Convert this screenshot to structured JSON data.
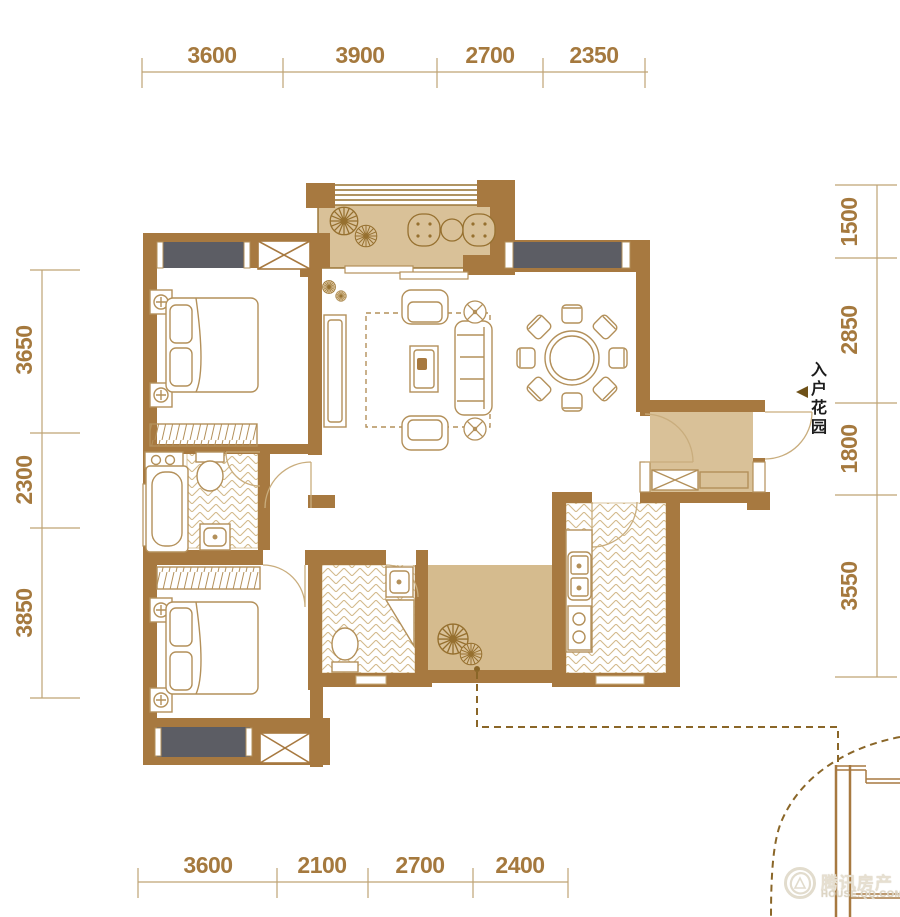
{
  "plan": {
    "dimensions": {
      "top": [
        "3600",
        "3900",
        "2700",
        "2350"
      ],
      "bottom": [
        "3600",
        "2100",
        "2700",
        "2400"
      ],
      "left": [
        "3650",
        "2300",
        "3850"
      ],
      "right": [
        "1500",
        "2850",
        "1800",
        "3550"
      ]
    },
    "labels": {
      "entry_garden": "入户花园"
    },
    "watermark": {
      "brand": "腾讯房产",
      "site": "HOUSE.QQ.COM"
    },
    "colors": {
      "wall": "#a77940",
      "tan_fill": "#d9c198",
      "window_gray": "#5c5d64",
      "dimension_text": "#a5793e",
      "furniture_stroke": "#b3905a",
      "dashed_line": "#8a6628"
    },
    "icons": {
      "entry_arrow": "left-triangle",
      "plants": "spiky-plant-icon",
      "shafts": "x-box-shaft-icon",
      "watermark_logo": "circle-logo-icon"
    }
  }
}
